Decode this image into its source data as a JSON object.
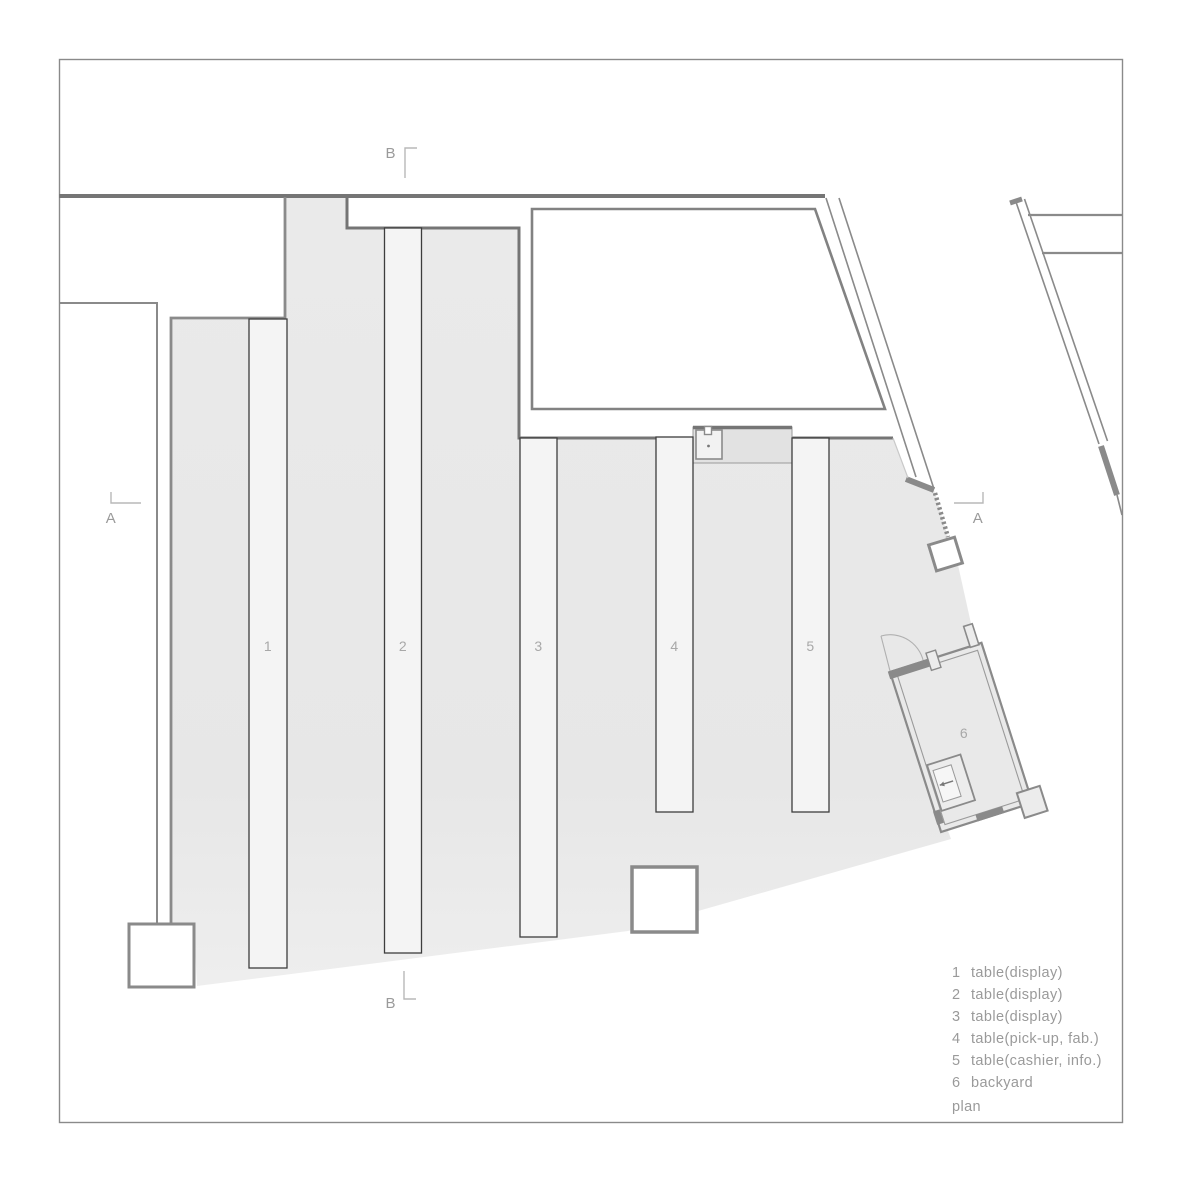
{
  "drawing": {
    "type_label": "plan",
    "tables": [
      {
        "number": "1"
      },
      {
        "number": "2"
      },
      {
        "number": "3"
      },
      {
        "number": "4"
      },
      {
        "number": "5"
      }
    ],
    "backyard": {
      "number": "6"
    },
    "section_markers": {
      "a": "A",
      "b": "B"
    }
  },
  "legend": {
    "items": [
      {
        "num": "1",
        "label": "table(display)"
      },
      {
        "num": "2",
        "label": "table(display)"
      },
      {
        "num": "3",
        "label": "table(display)"
      },
      {
        "num": "4",
        "label": "table(pick-up, fab.)"
      },
      {
        "num": "5",
        "label": "table(cashier, info.)"
      },
      {
        "num": "6",
        "label": "backyard"
      }
    ],
    "plan_label": "plan"
  },
  "colors": {
    "wall": "#8a8a8a",
    "wall_dark": "#757575",
    "floor": "#e9e9e9",
    "table_fill": "#f4f4f4",
    "table_border": "#3d3d3d",
    "counter": "#e2e2e2",
    "text": "#9a9a9a",
    "plan_number_label": "#a8a8a8",
    "marker_line": "#b8b8b8",
    "background": "#ffffff"
  }
}
